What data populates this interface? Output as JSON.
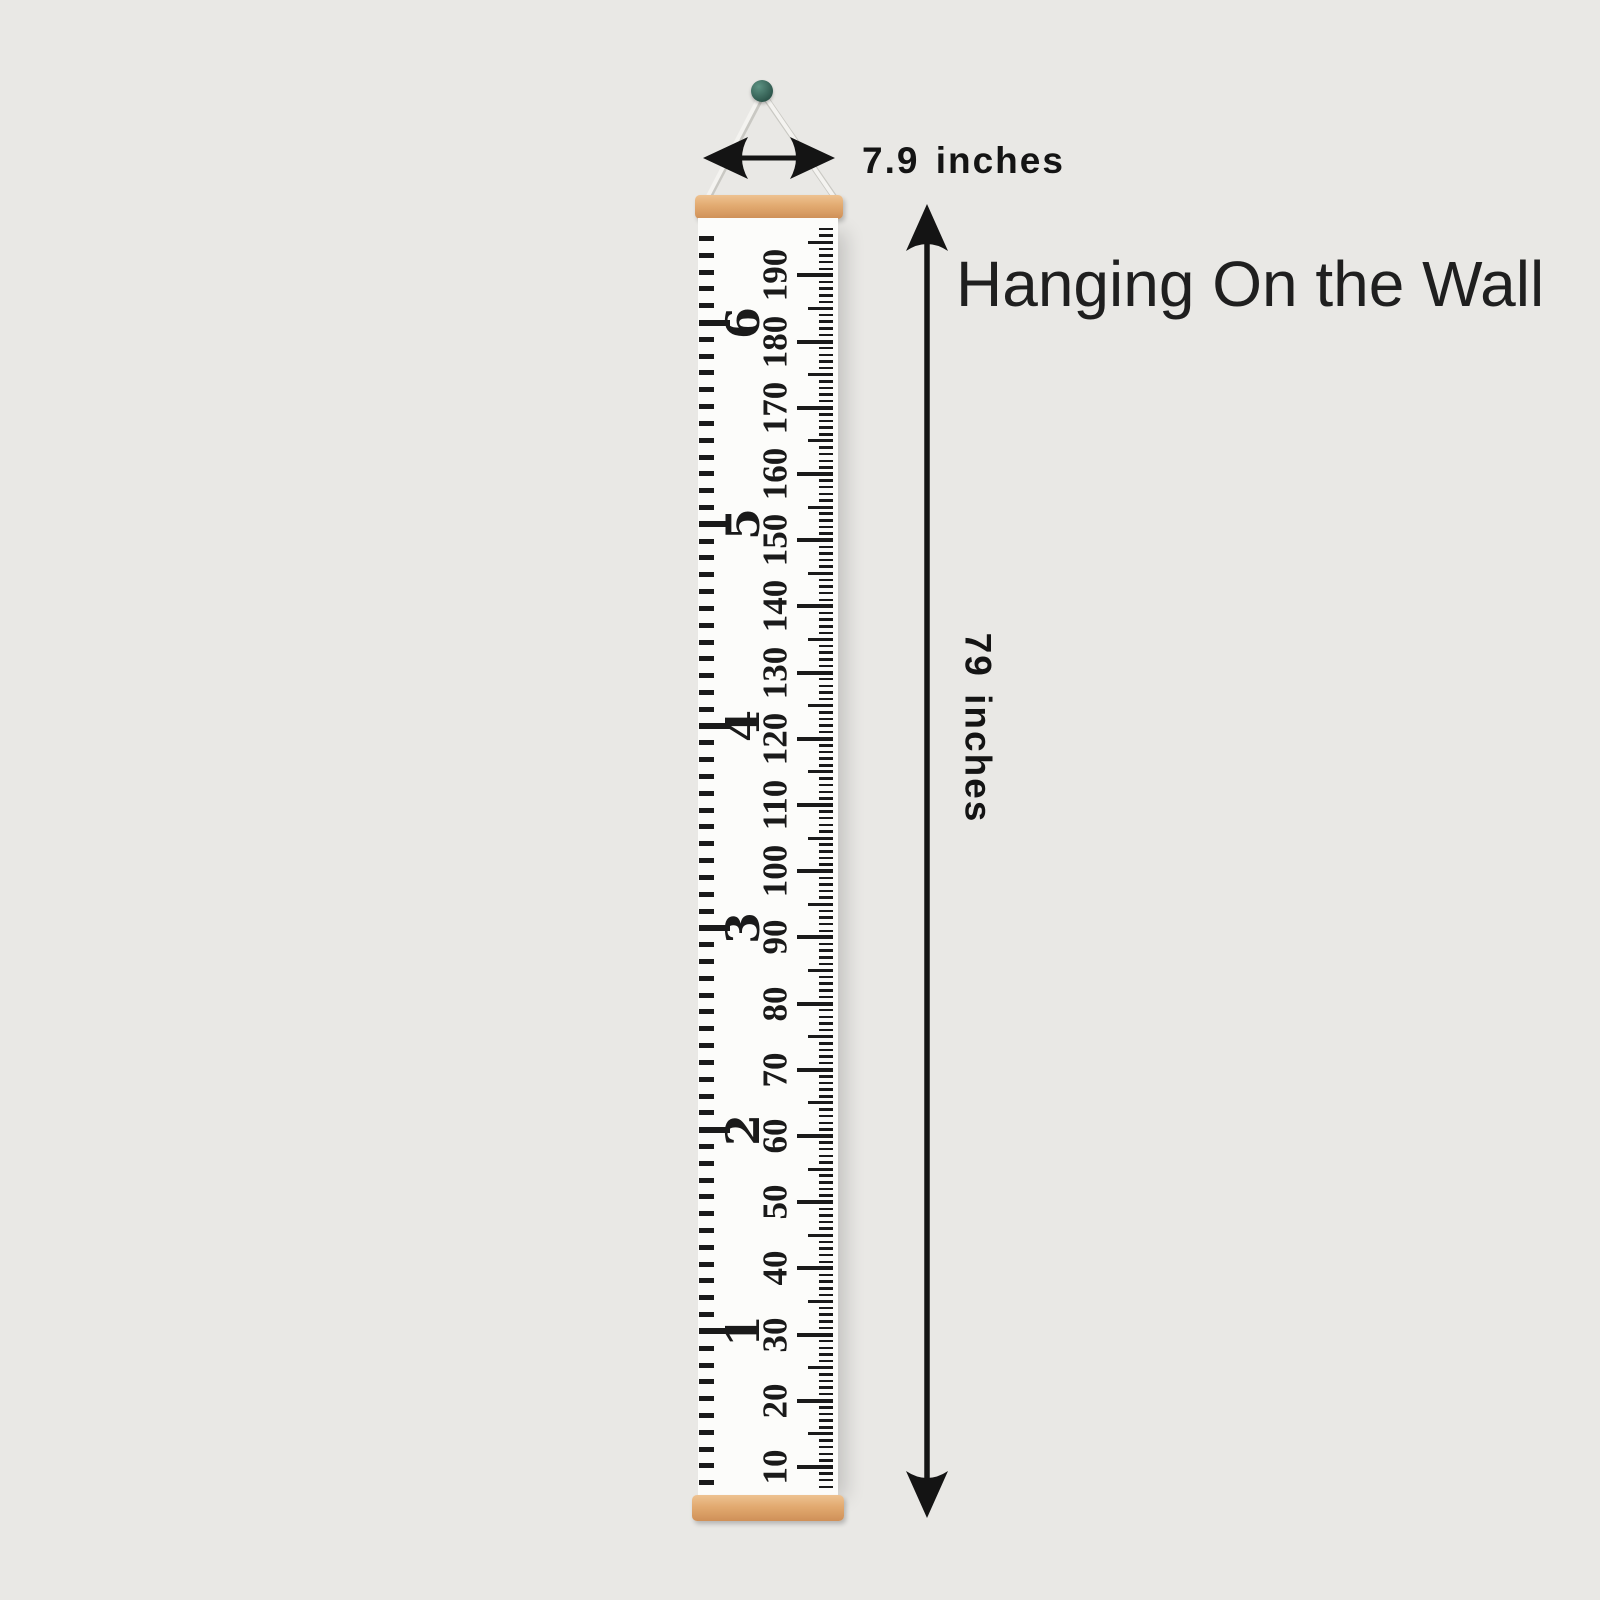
{
  "caption": {
    "text": "Hanging On the Wall"
  },
  "width_dimension": {
    "label": "7.9 inches"
  },
  "height_dimension": {
    "label": "79 inches"
  },
  "colors": {
    "background": "#e9e8e5",
    "canvas": "#fcfcfa",
    "ink": "#1a1a1a",
    "arrow": "#141414",
    "wood_light": "#eec291",
    "wood_dark": "#cf9058",
    "pin_light": "#5d9383",
    "pin_dark": "#2c544a",
    "string": "#f4f3f0",
    "string_shadow": "#c9c8c3"
  },
  "ruler": {
    "cm_scale": {
      "tick_min": 7,
      "tick_max": 197,
      "medium_every": 5,
      "major_every": 10
    },
    "cm_labels": [
      "10",
      "20",
      "30",
      "40",
      "50",
      "60",
      "70",
      "80",
      "90",
      "100",
      "110",
      "120",
      "130",
      "140",
      "150",
      "160",
      "170",
      "180",
      "190"
    ],
    "inch_scale": {
      "tick_min": 3,
      "tick_max": 77,
      "foot_every": 12
    },
    "feet_labels": [
      "1",
      "2",
      "3",
      "4",
      "5",
      "6"
    ]
  }
}
